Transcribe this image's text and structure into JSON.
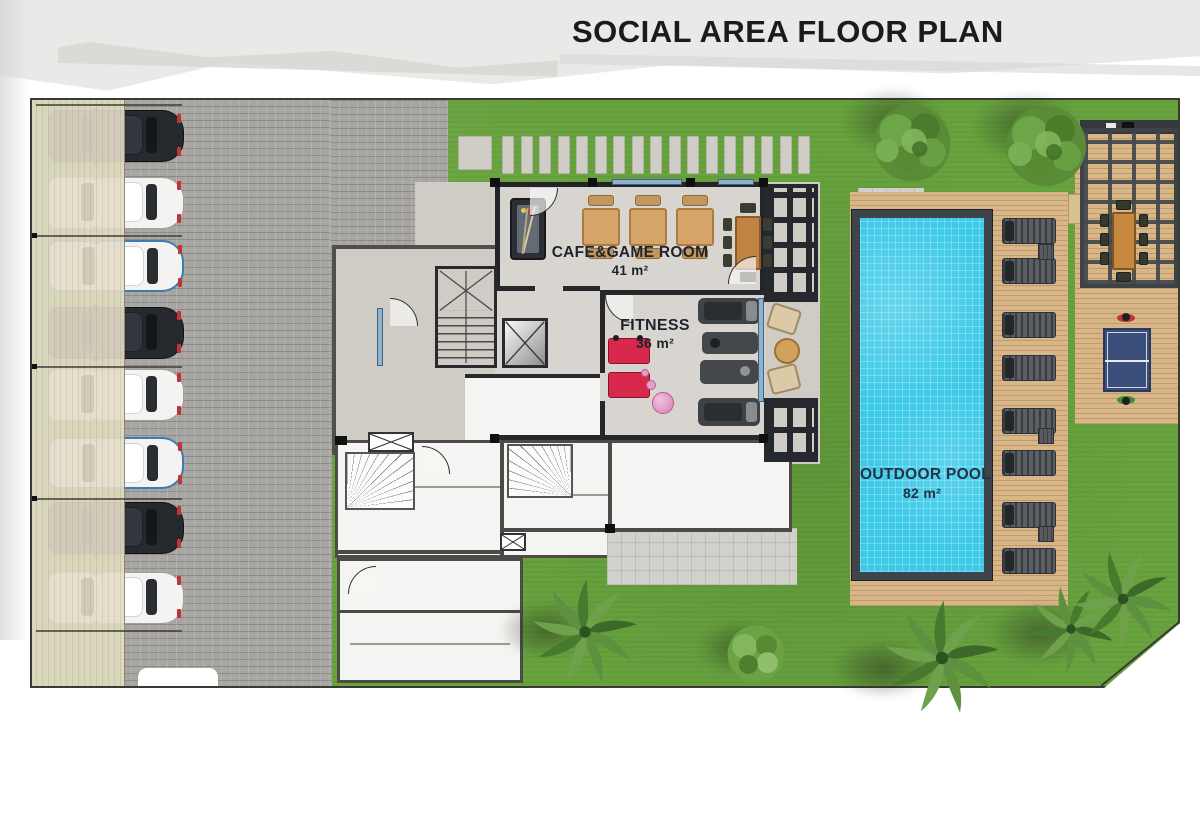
{
  "title": "SOCIAL AREA FLOOR PLAN",
  "rooms": {
    "cafe_game": {
      "label": "CAFE&GAME ROOM",
      "area": "41 m²"
    },
    "fitness": {
      "label": "FITNESS",
      "area": "36 m²"
    },
    "outdoor_pool": {
      "label": "OUTDOOR POOL",
      "area": "82 m²"
    }
  },
  "colors": {
    "grass": "#68a33e",
    "pool_water": "#3ccae8",
    "wood_deck": "#d9b687",
    "paver": "#a8a6a2",
    "carport_canopy": "#e5ddc9",
    "wall": "#26262b",
    "title_text": "#1b1b1a",
    "label_text": "#1f242b",
    "fitness_equipment_accent": "#d6294b",
    "table_tennis_blue": "#3b4e7a"
  },
  "parking": {
    "car_count": 8,
    "cars": [
      {
        "style": "sedan-dark"
      },
      {
        "style": "suv-white"
      },
      {
        "style": "van-white-blue"
      },
      {
        "style": "sedan-dark"
      },
      {
        "style": "suv-white"
      },
      {
        "style": "van-white-blue"
      },
      {
        "style": "sedan-dark"
      },
      {
        "style": "suv-white"
      }
    ]
  },
  "pool_deck": {
    "lounger_count": 8,
    "side_table_count": 3
  },
  "cafe": {
    "table_count": 3
  },
  "pergola_dining": {
    "side_chair_rows": 3
  },
  "landscape": {
    "stepping_stones_row": 17,
    "stepping_steps_column": 6
  }
}
